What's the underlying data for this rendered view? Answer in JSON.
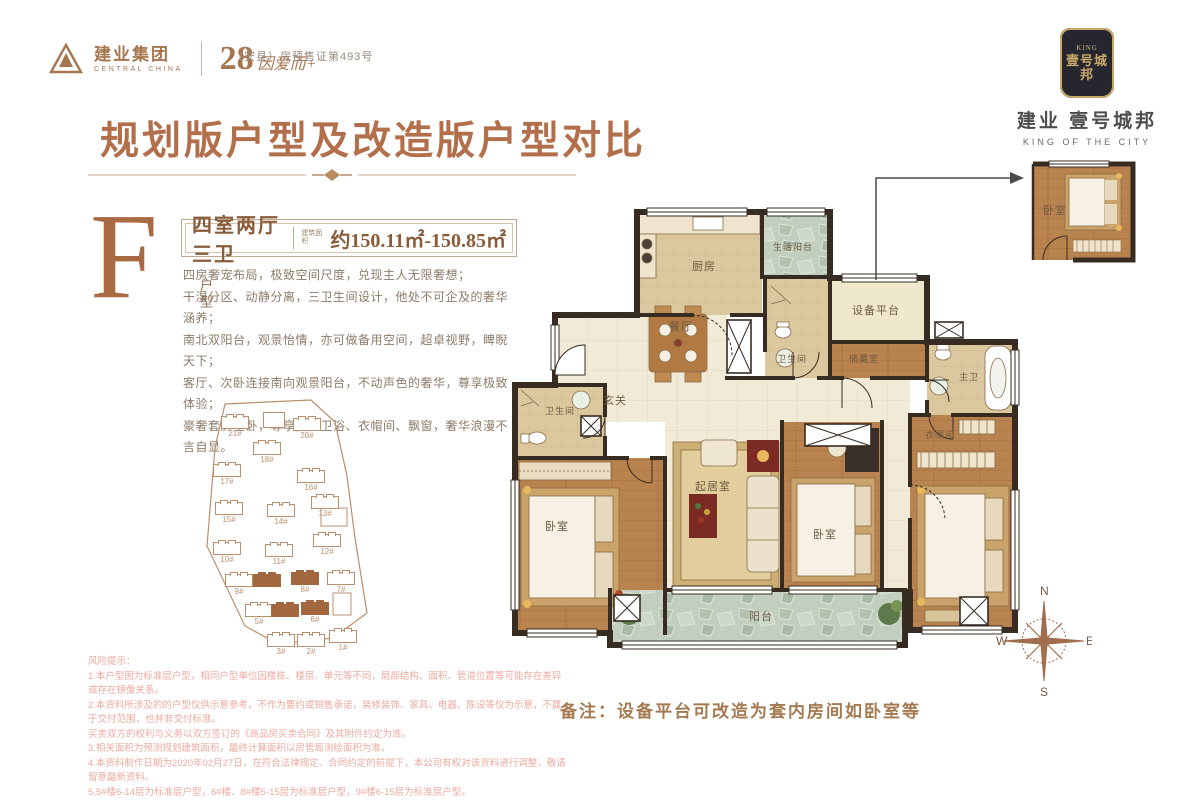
{
  "header": {
    "logo_cn": "建业集团",
    "logo_en": "CENTRAL CHINA",
    "anniversary": "28",
    "anniversary_tagline": "因爱而+",
    "permit": "（安县）房预售证第493号",
    "emblem_top": "KING",
    "emblem_cn": "壹号城邦",
    "brand_cn": "建业 壹号城邦",
    "brand_en": "KING OF THE CITY"
  },
  "title": "规划版户型及改造版户型对比",
  "unit": {
    "letter": "F",
    "letter_suffix": "户型",
    "layout": "四室两厅三卫",
    "area_label": "建筑面积",
    "area_value": "约150.11㎡-150.85㎡",
    "features": [
      "四房奢宠布局，极致空间尺度，兑现主人无限奢想；",
      "干湿分区、动静分离，三卫生间设计，他处不可企及的奢华涵养；",
      "南北双阳台，观景怡情，亦可做备用空间，超卓视野，睥睨天下；",
      "客厅、次卧连接南向观景阳台，不动声色的奢华，尊享极致体验；",
      "豪奢套房主卧，尊享独立卫浴、衣帽间、飘窗，奢华浪漫不言自显。"
    ]
  },
  "plan": {
    "kitchen": "厨房",
    "service_balcony": "生活阳台",
    "equipment": "设备平台",
    "dining": "餐厅",
    "bath_center": "卫生间",
    "storage": "储藏室",
    "master_bath": "主卫",
    "foyer": "玄关",
    "bath_left": "卫生间",
    "bedroom_left": "卧室",
    "living": "起居室",
    "bedroom_mid": "卧室",
    "closet": "衣帽间",
    "balcony": "阳台",
    "inset_bedroom": "卧室"
  },
  "note": "备注：设备平台可改造为套内房间如卧室等",
  "compass": {
    "n": "N",
    "e": "E",
    "s": "S",
    "w": "W"
  },
  "siteplan": {
    "buildings": [
      {
        "x": 38,
        "y": 28,
        "l": "21#"
      },
      {
        "x": 80,
        "y": 24,
        "box": true
      },
      {
        "x": 110,
        "y": 30,
        "l": "20#"
      },
      {
        "x": 70,
        "y": 54,
        "l": "18#"
      },
      {
        "x": 30,
        "y": 76,
        "l": "17#"
      },
      {
        "x": 114,
        "y": 82,
        "l": "16#"
      },
      {
        "x": 32,
        "y": 114,
        "l": "15#"
      },
      {
        "x": 84,
        "y": 116,
        "l": "14#"
      },
      {
        "x": 128,
        "y": 108,
        "l": "13#"
      },
      {
        "x": 130,
        "y": 146,
        "l": "12#"
      },
      {
        "x": 30,
        "y": 154,
        "l": "10#"
      },
      {
        "x": 82,
        "y": 156,
        "l": "11#"
      },
      {
        "x": 42,
        "y": 186,
        "l": "9#"
      },
      {
        "x": 70,
        "y": 186,
        "filled": true
      },
      {
        "x": 108,
        "y": 184,
        "filled": true,
        "l": "8#"
      },
      {
        "x": 144,
        "y": 184,
        "l": "7#"
      },
      {
        "x": 62,
        "y": 216,
        "l": "5#"
      },
      {
        "x": 88,
        "y": 216,
        "filled": true
      },
      {
        "x": 118,
        "y": 214,
        "filled": true,
        "l": "6#"
      },
      {
        "x": 84,
        "y": 246,
        "l": "3#"
      },
      {
        "x": 114,
        "y": 246,
        "l": "2#"
      },
      {
        "x": 146,
        "y": 242,
        "l": "1#"
      }
    ]
  },
  "disclaimer": {
    "title": "风险提示：",
    "lines": [
      "1.本户型图为标准层户型，相同户型单位因楼栋、楼层、单元等不同，局部结构、面积、管道位置等可能存在差异或存在镜像关系。",
      "2.本资料所涉及的的户型仅供示意参考，不作为要约或销售承诺，装修装饰、家具、电器、陈设等仅为示意，不属于交付范围，也并非交付标准。",
      "买卖双方的权利与义务以双方签订的《商品房买卖合同》及其附件约定为准。",
      "3.相关面积为预测规划建筑面积，最终计算面积以房管局测绘面积为准。",
      "4.本资料制作日期为2020年02月27日，在符合法律规定、合同约定的前提下，本公司有权对该资料进行调整，敬请留意最新资料。",
      "5.5#楼6-14层为标准层户型，6#楼、8#楼5-15层为标准层户型，9#楼6-15层为标准层户型。"
    ]
  },
  "colors": {
    "accent_brown": "#b26f4b",
    "deep_brown": "#8a5c3a",
    "wall": "#372c22",
    "wood_floor": "#b9834f",
    "stone_green": "#c2cfbf",
    "disclaimer_pink": "#edaa9f"
  }
}
